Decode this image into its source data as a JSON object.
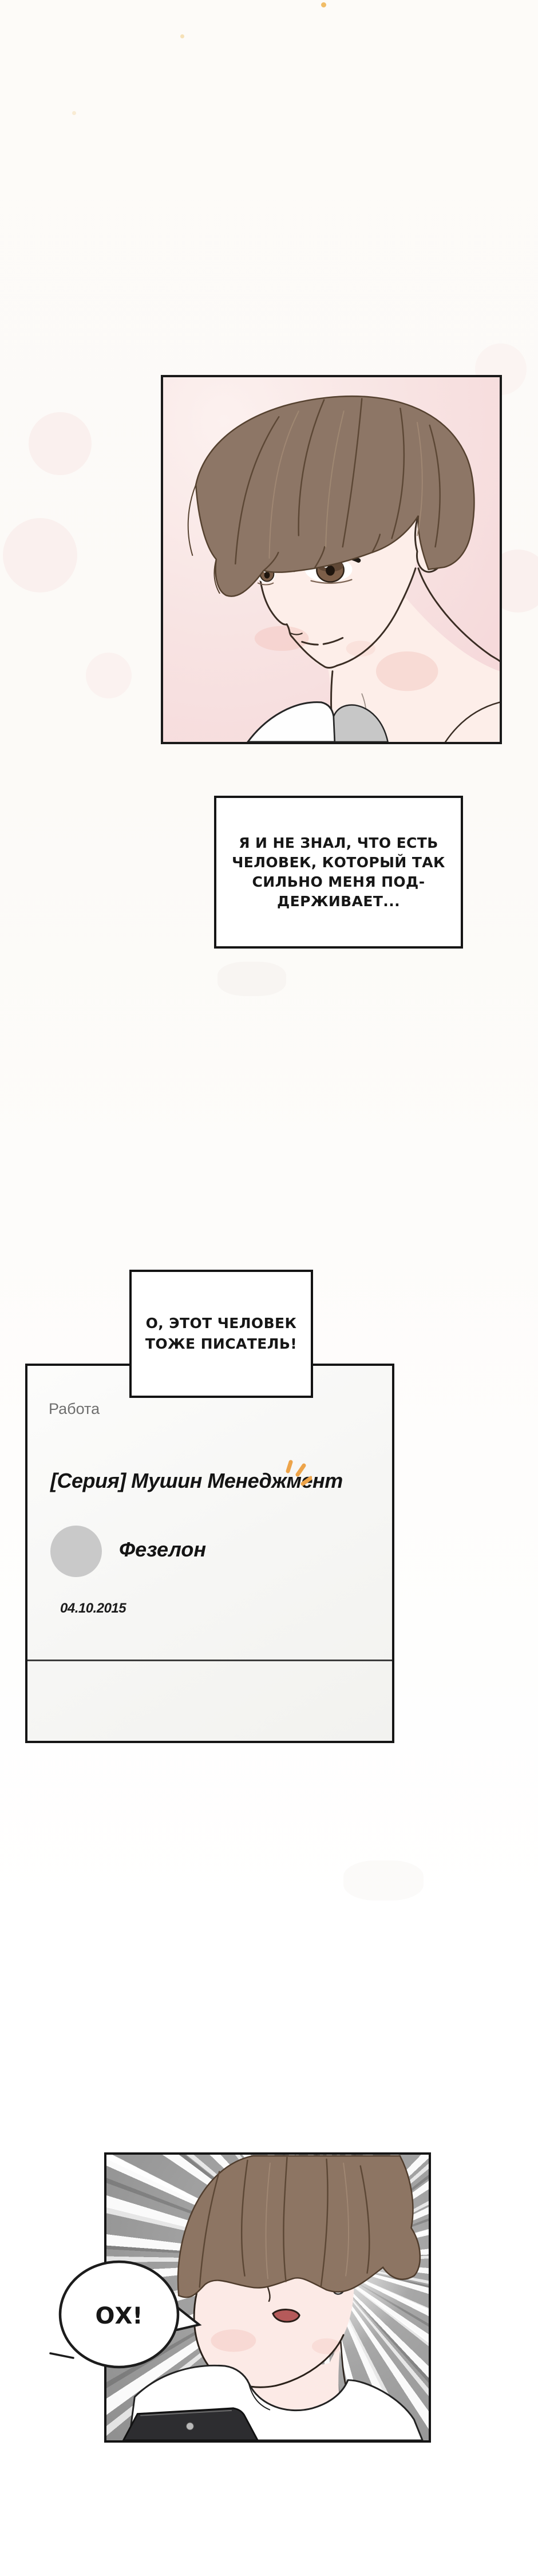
{
  "page": {
    "kind": "webtoon-page"
  },
  "panel1": {
    "description": "portrait of a young man with brown hair on pink background"
  },
  "caption1": {
    "lines": [
      "Я И НЕ ЗНАЛ, ЧТО ЕСТЬ",
      "ЧЕЛОВЕК, КОТОРЫЙ ТАК",
      "СИЛЬНО МЕНЯ ПОД-",
      "ДЕРЖИВАЕТ..."
    ]
  },
  "bubble2": {
    "lines": [
      "О, ЭТОТ ЧЕЛОВЕК",
      "ТОЖЕ ПИСАТЕЛЬ!"
    ]
  },
  "blog_card": {
    "category": "Работа",
    "title": "[Серия] Мушин Менеджмент",
    "author": "Фезелон",
    "date": "04.10.2015"
  },
  "panel3": {
    "exclamation": "ОХ!",
    "description": "shocked young man looking at phone, speed-line background"
  },
  "colors": {
    "panel_border": "#1a1a1a",
    "pink_background": "#f5d6d8",
    "gray_background": "#a0a0a0",
    "accent_orange": "#eda44a",
    "avatar_gray": "#c9c9c9",
    "divider_gray": "#3c3c3c",
    "category_gray": "#6f6f6f"
  }
}
